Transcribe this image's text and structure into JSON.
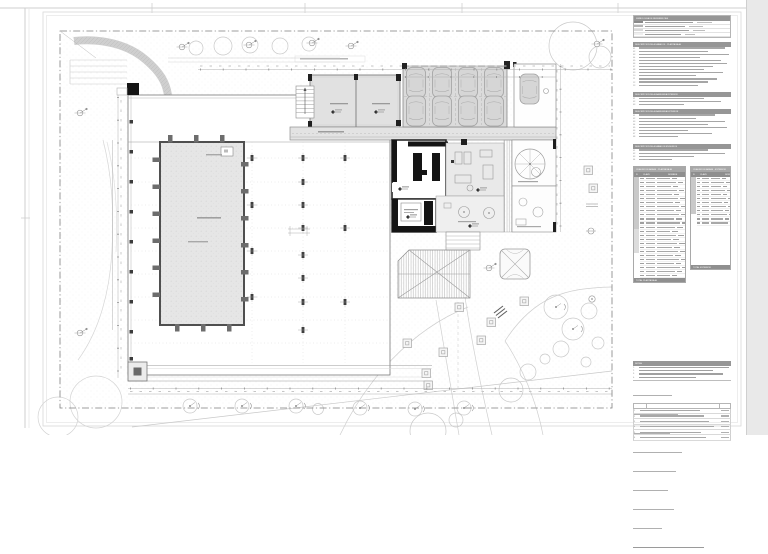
{
  "document": {
    "type": "architectural-site-plan",
    "sheet_background": "#ffffff",
    "margin_background": "#e9e9e9"
  },
  "colors": {
    "header_bar": "#969696",
    "table_header": "#8f8f8f",
    "fill_light": "#e4e4e4",
    "fill_parking": "#dbdbdb",
    "wall_poche": "#141414",
    "boundary_line": "#7f7f7f"
  },
  "drawing": {
    "parking_cars_row1": 4,
    "parking_cars_row2": 4,
    "driveway_cars": 1,
    "hall_column_stubs_left": 6,
    "boundary_style": "dash-dot"
  },
  "panel": {
    "legend": {
      "title": "SIMBOLOGIA DE REFERENCIAS",
      "rows": [
        {
          "swatch": "#8a8a8a",
          "w": 50,
          "w2": 16
        },
        {
          "swatch": "#b5b5b5",
          "w": 42,
          "w2": 14
        },
        {
          "swatch": "#d9d9d9",
          "w": 46,
          "w2": 12
        },
        {
          "swatch": "#efefef",
          "w": 38,
          "w2": 10
        }
      ]
    },
    "sections": [
      {
        "title": "DESCRIPCION DE ACABADOS · PLANTA BAJA",
        "items": [
          88,
          70,
          92,
          62,
          84,
          90,
          76,
          66,
          86,
          58,
          80,
          70,
          60
        ]
      },
      {
        "title": "DESCRIPCION DE ALBANILERIA INTERIOR",
        "items": [
          66,
          84,
          46
        ]
      },
      {
        "title": "DESCRIPCION DE ALBANILERIA EXTERIOR",
        "items": [
          78,
          58,
          88,
          70,
          90,
          50,
          74,
          40
        ]
      },
      {
        "title": "DESCRIPCION DE ACABADOS EN MUROS",
        "items": [
          70,
          88,
          56,
          34
        ]
      }
    ],
    "tables": [
      {
        "title": "CUADRO DE AREAS · PLANTA BAJA",
        "headers": [
          "N",
          "CLAVE",
          "NOMBRE",
          "AREA"
        ],
        "rows": 25,
        "group_split": 17,
        "blank_rows": 0,
        "footer": "TOTAL PLANTA BAJA",
        "width": 53
      },
      {
        "title": "CUADRO DE AREAS · EXTERIOR",
        "headers": [
          "N",
          "CLAVE",
          "NOMBRE",
          "AREA"
        ],
        "rows": 12,
        "group_split": 12,
        "blank_rows": 13,
        "footer": "TOTAL EXTERIOR",
        "width": 41
      }
    ],
    "notes": {
      "title": "NOTAS",
      "items": [
        92,
        76,
        86,
        58
      ],
      "abbreviations": [
        40,
        46,
        38,
        50,
        44,
        36,
        42,
        30
      ],
      "closing": 72
    },
    "revisions": {
      "rows": 6
    }
  }
}
